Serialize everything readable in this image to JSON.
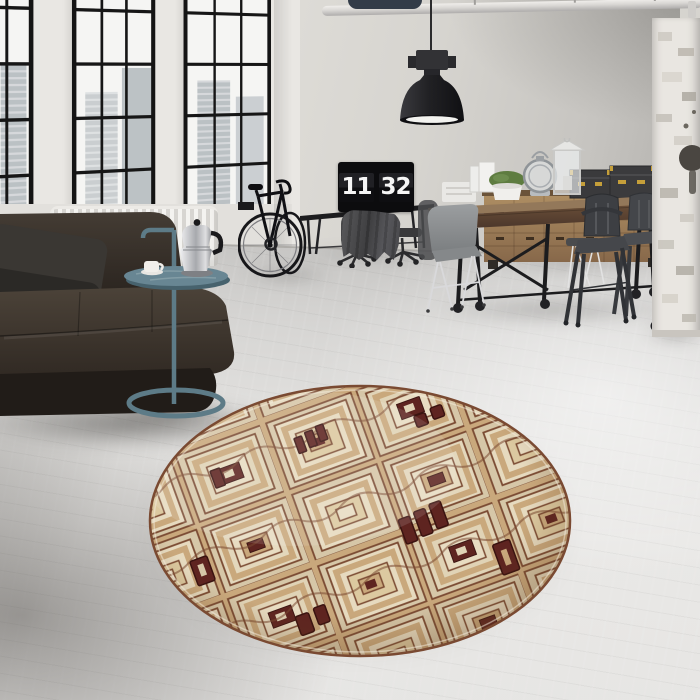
{
  "scene": {
    "kind": "interior-photo",
    "room": "industrial loft living space",
    "clock": {
      "hours": "11",
      "minutes": "32"
    },
    "palette": {
      "wall": "#d6d4cf",
      "wall_dark": "#b3b1ad",
      "pillar": "#e9e7e3",
      "glass": "#f5f5f3",
      "frame": "#141414",
      "floor_light": "#e9e8e6",
      "floor_mid": "#d6d5d3",
      "sofa": "#332c25",
      "pillow": "#3a3733",
      "radiator": "#f0efec",
      "side_table": "#5d7b87",
      "monitor": "#0c0c0e",
      "clock_digits": "#f5f5f5",
      "jacket": "#4a4a4d",
      "column": "#e9e6e1",
      "pipe": "#d9d7d4",
      "wood_table": "#8d7257",
      "wood_sideboard": "#a9895f",
      "box_black": "#3a3a3c",
      "box_brass": "#c59f3a",
      "plant_green": "#5e7c40",
      "chair_gray": "#8b8e90",
      "chair_dark_metal": "#3d3f43",
      "lamp_black": "#212124",
      "rug_cream": "#e3d7bc",
      "rug_tan": "#c9a87c",
      "rug_line": "#7a4a32",
      "rug_maroon": "#5e2420"
    },
    "objects": [
      "industrial-windows",
      "city-view",
      "pendant-lamp",
      "ceiling-pipe",
      "leather-sofa",
      "cushion-pillow",
      "radiator",
      "side-table",
      "coffee-cup",
      "moka-pot",
      "bicycle",
      "desk",
      "flip-clock-monitor",
      "jacket",
      "office-stools",
      "dining-table",
      "wood-sideboard",
      "storage-boxes",
      "potted-plant",
      "glass-lantern",
      "white-lantern",
      "gray-shell-chair",
      "metal-cafe-chairs",
      "office-chair",
      "brick-column",
      "round-kuba-rug",
      "concrete-floor"
    ]
  }
}
